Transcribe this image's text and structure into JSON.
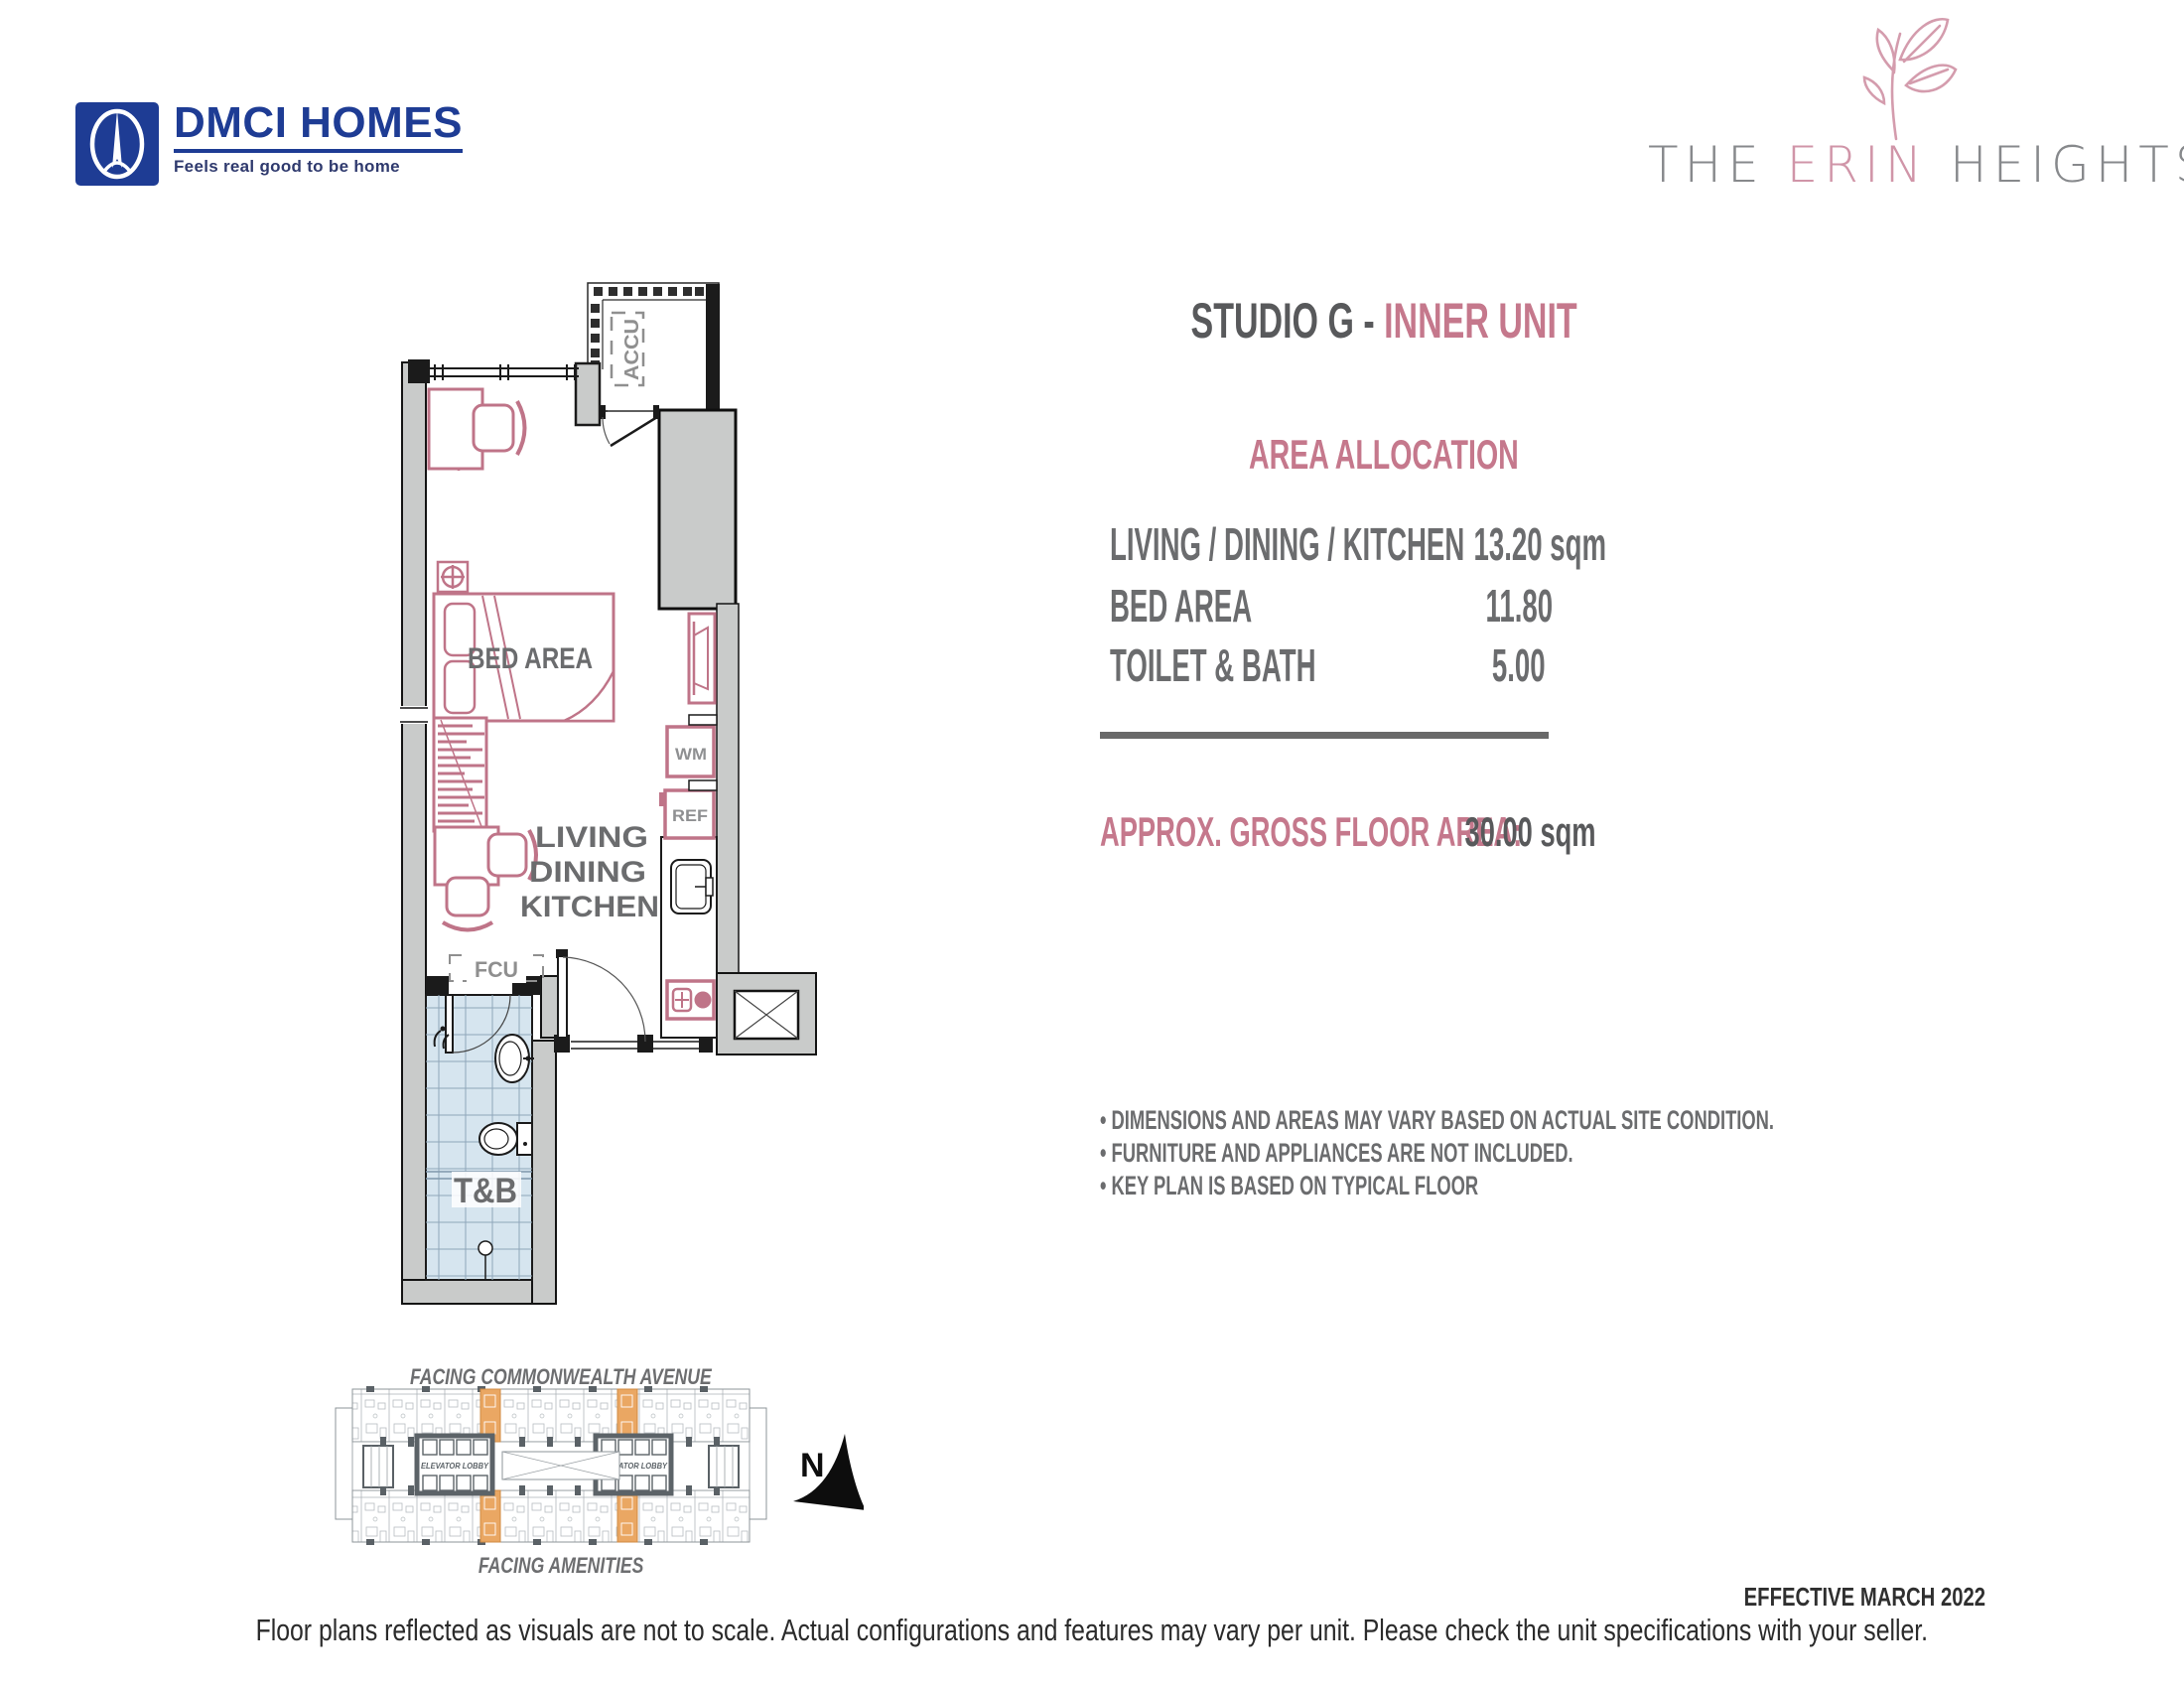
{
  "header": {
    "dmci": {
      "name": "DMCI HOMES",
      "tagline": "Feels real good to be home"
    },
    "erin": {
      "the": "THE",
      "erin": "ERIN",
      "heights": "HEIGHTS"
    }
  },
  "title": {
    "prefix": "STUDIO G - ",
    "highlight": "INNER UNIT"
  },
  "area_allocation": {
    "heading": "AREA ALLOCATION",
    "rows": [
      {
        "label": "LIVING / DINING / KITCHEN",
        "value": "13.20 sqm"
      },
      {
        "label": "BED AREA",
        "value": "11.80"
      },
      {
        "label": "TOILET & BATH",
        "value": "5.00"
      }
    ],
    "gross_label": "APPROX. GROSS FLOOR AREA:",
    "gross_value": "30.00 sqm"
  },
  "notes": [
    "DIMENSIONS AND AREAS MAY VARY BASED ON ACTUAL SITE CONDITION.",
    "FURNITURE AND APPLIANCES ARE NOT INCLUDED.",
    "KEY PLAN IS BASED ON TYPICAL FLOOR"
  ],
  "floor_plan": {
    "labels": {
      "accu": "ACCU",
      "bed_area": "BED AREA",
      "living": "LIVING",
      "dining": "DINING",
      "kitchen": "KITCHEN",
      "wm": "WM",
      "ref": "REF",
      "fcu": "FCU",
      "toilet_bath": "T&B"
    }
  },
  "key_plan": {
    "facing_top": "FACING COMMONWEALTH AVENUE",
    "facing_bottom": "FACING AMENITIES",
    "elevator_lobby_left": "ELEVATOR LOBBY",
    "elevator_lobby_right": "ELEVATOR LOBBY",
    "north": "N"
  },
  "footer": {
    "effective": "EFFECTIVE MARCH 2022",
    "disclaimer": "Floor plans reflected as visuals are not to scale. Actual configurations and features may vary per unit. Please check the unit specifications with your seller."
  },
  "colors": {
    "accent_pink_text": "#c5788c",
    "furniture_pink": "#bf7488",
    "text_gray": "#6b6c6e",
    "wall_gray": "#c9cbca",
    "wall_black": "#1b1b1b",
    "tile_blue": "#d6e5ef",
    "tile_grid": "#8fa7ba",
    "keyplan_orange": "#eaa763",
    "dmci_blue": "#1e3c94",
    "erin_pink": "#d095a8",
    "erin_gray": "#87898c"
  }
}
